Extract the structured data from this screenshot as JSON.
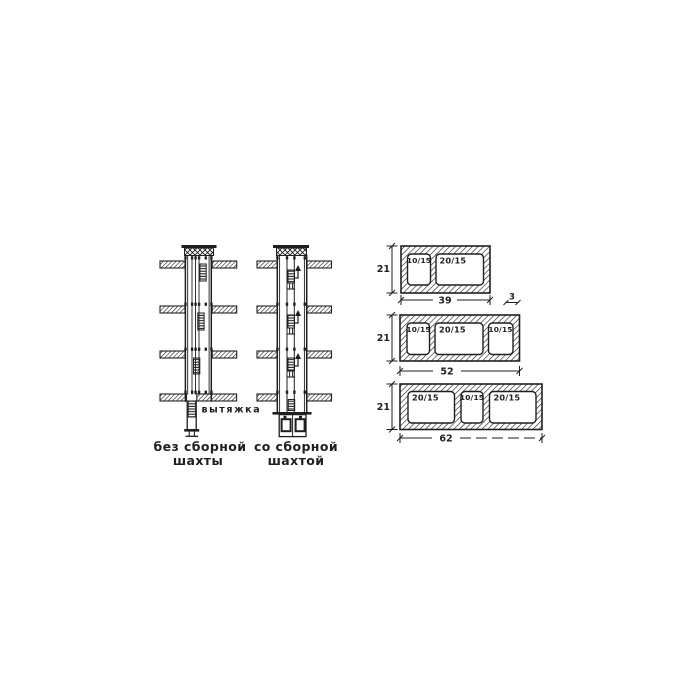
{
  "figure": {
    "background": "#ffffff",
    "ink_color": "#1f1f1f",
    "left_diagram": {
      "exhaust_label": "вытяжка",
      "caption1": "без сборной",
      "caption2": "шахты"
    },
    "right_diagram": {
      "caption1": "со сборной",
      "caption2": "шахтой"
    },
    "sections": [
      {
        "height": "21",
        "width": "39",
        "wall_thickness": "3",
        "openings": [
          "10/15",
          "20/15"
        ]
      },
      {
        "height": "21",
        "width": "52",
        "openings": [
          "10/15",
          "20/15",
          "10/15"
        ]
      },
      {
        "height": "21",
        "width": "62",
        "openings": [
          "20/15",
          "10/15",
          "20/15"
        ]
      }
    ]
  }
}
